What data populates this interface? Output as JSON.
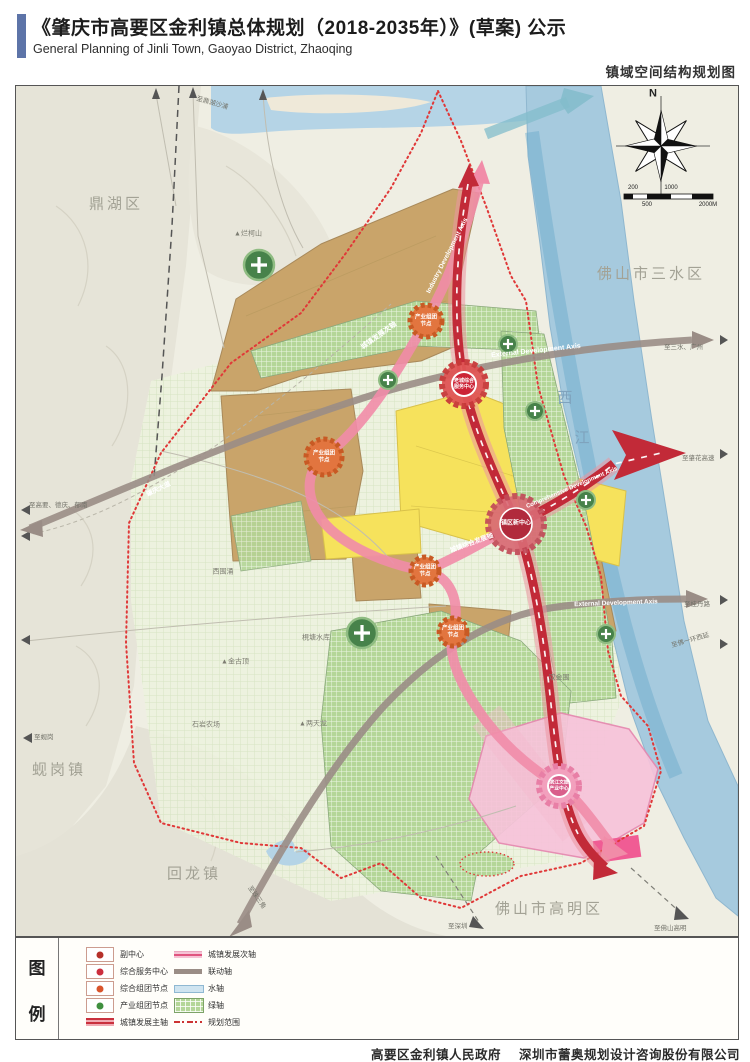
{
  "header": {
    "title_zh": "《肇庆市高要区金利镇总体规划（2018-2035年）》(草案) 公示",
    "title_en": "General Planning of Jinli Town, Gaoyao District, Zhaoqing",
    "map_name": "镇域空间结构规划图"
  },
  "map": {
    "compass_n": "N",
    "scale": {
      "t1": "200",
      "t2": "1000",
      "b1": "500",
      "b2": "2000M"
    },
    "regions": {
      "dinghu": "鼎湖区",
      "sanshui": "佛山市三水区",
      "gaoming": "佛山市高明区",
      "huilong": "回龙镇",
      "xiangang": "蚬岗镇",
      "xijiang_1": "西",
      "xijiang_2": "江"
    },
    "places": {
      "lankeshan": "▲烂柯山",
      "jinguding": "▲金古顶",
      "liangtianlong": "▲两天龙",
      "xiweichong": "西围涌",
      "jiantang": "梘塘水库",
      "shiyan": "石岩农场",
      "shuangjinwei": "双金围"
    },
    "directions": {
      "to_dinghu": "至鼎湖沙浦",
      "to_gaoyao": "至高要、德庆、郁南",
      "to_xiangang": "至蚬岗",
      "to_sanshui": "至三水、广州",
      "to_zhaohua": "至肇花高速",
      "to_guidan": "至桂丹路",
      "to_fsring": "至佛一环西延",
      "to_shenzhen": "至深圳",
      "to_gaoming": "至佛山高明",
      "to_pearl": "至珠三角",
      "zq_avenue": "肇庆大道"
    },
    "axes": {
      "external_en": "External Development Axis",
      "external2_en": "External Development Axis",
      "industry_en": "Industry Development Axis",
      "comprehensive_en": "Comprehensive Development Axis",
      "secondary_zh": "城镇发展次轴",
      "comprehensive_zh": "城镇综合发展轴"
    },
    "nodes": {
      "industry_l1": "产业组团",
      "industry_l2": "节点",
      "oldtown_l1": "老城综合",
      "oldtown_l2": "服务中心",
      "newcenter": "镇区新中心",
      "binjiang_l1": "滨江文旅",
      "binjiang_l2": "产业中心"
    }
  },
  "legend": {
    "title_1": "图",
    "title_2": "例",
    "col1": [
      {
        "label": "副中心"
      },
      {
        "label": "综合服务中心"
      },
      {
        "label": "综合组团节点"
      },
      {
        "label": "产业组团节点"
      },
      {
        "label": "城镇发展主轴"
      }
    ],
    "col2": [
      {
        "label": "城镇发展次轴"
      },
      {
        "label": "联动轴"
      },
      {
        "label": "水轴"
      },
      {
        "label": "绿轴"
      },
      {
        "label": "规划范围"
      }
    ]
  },
  "footer": {
    "gov": "高要区金利镇人民政府",
    "company": "深圳市蕾奥规划设计咨询股份有限公司"
  },
  "colors": {
    "accent": "#5d74a8",
    "main_axis_red": "#c22a38",
    "secondary_axis_pink": "#f18ca8",
    "linkage_axis_gray": "#9a8d86",
    "water_blue": "#a6cade",
    "green_axis": "#b4d698",
    "industrial_node_orange": "#e2753f",
    "yellow_zone": "#f6e25c",
    "brown_zone": "#c9a46a",
    "pink_zone": "#f7c3da"
  }
}
